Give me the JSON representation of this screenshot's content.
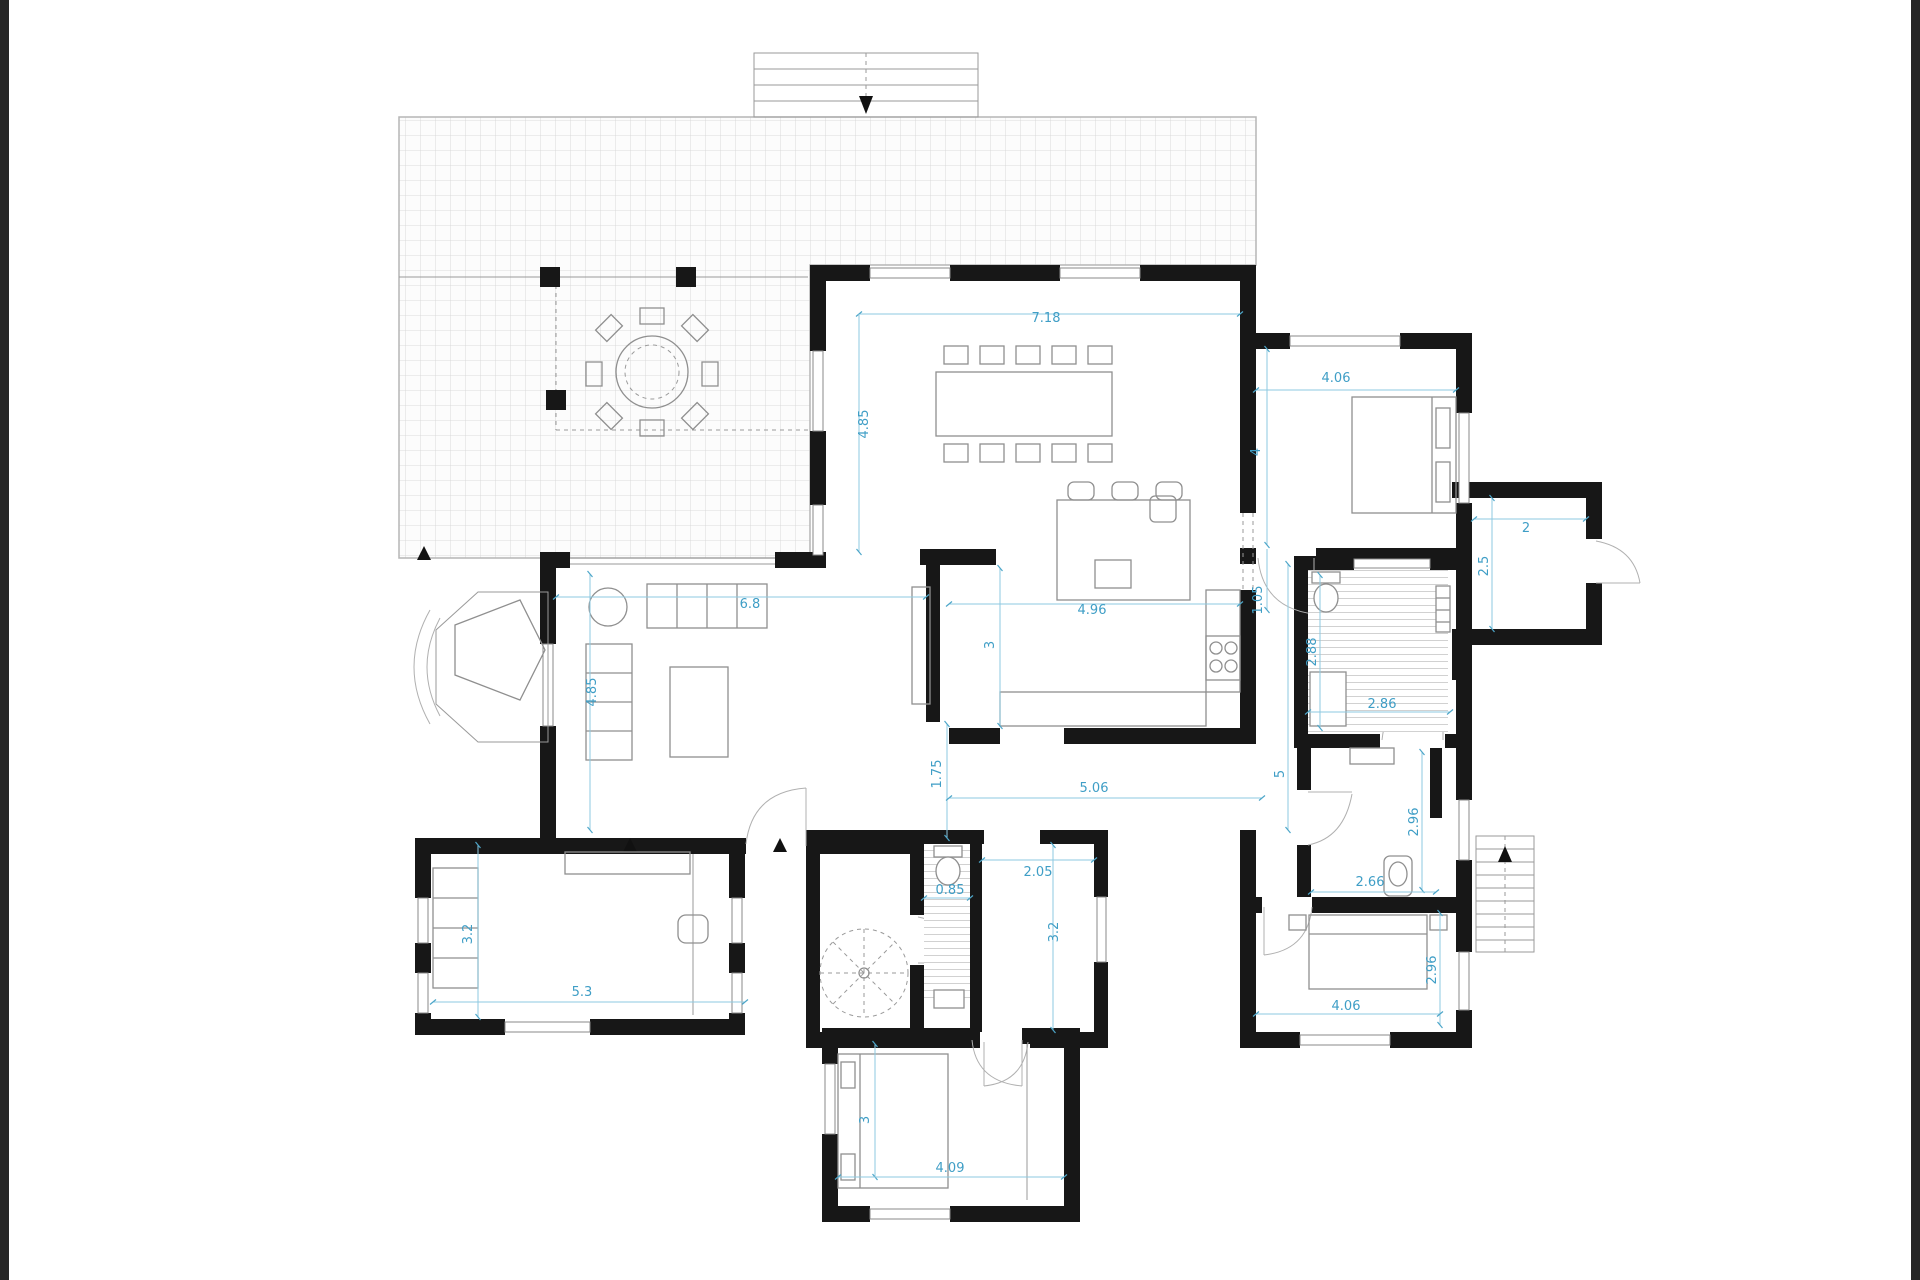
{
  "drawing": {
    "kind": "residential floor plan",
    "units": "meters"
  },
  "colors": {
    "wall": "#171717",
    "dimension": "#3f9ec6",
    "furniture": "#8f8f8f",
    "tile": "#cfcfcf",
    "background": "#ffffff",
    "edge_bar": "#262626"
  },
  "dims": {
    "dining": {
      "width": "7.18",
      "depth": "4.85"
    },
    "living": {
      "width": "6.8",
      "depth": "4.85"
    },
    "kitchen": {
      "width": "4.96",
      "depth": "3",
      "passage": "1.75",
      "span": "5.06"
    },
    "corridor": {
      "bedroom_depth": "4",
      "door": "1.05",
      "length": "5"
    },
    "bedroom_top_right": {
      "width": "4.06"
    },
    "vestibule": {
      "width": "2",
      "depth": "2.5"
    },
    "bathroom": {
      "depth": "2.88",
      "width": "2.86"
    },
    "laundry": {
      "depth": "2.96",
      "width": "2.66"
    },
    "bedroom_bottom_right": {
      "depth": "2.96",
      "width": "4.06"
    },
    "hall": {
      "width": "2.05",
      "depth": "3.2"
    },
    "wc": {
      "width": "0.85"
    },
    "office": {
      "width": "5.3",
      "depth": "3.2"
    },
    "bedroom_bottom": {
      "width": "4.09",
      "depth": "3"
    }
  }
}
